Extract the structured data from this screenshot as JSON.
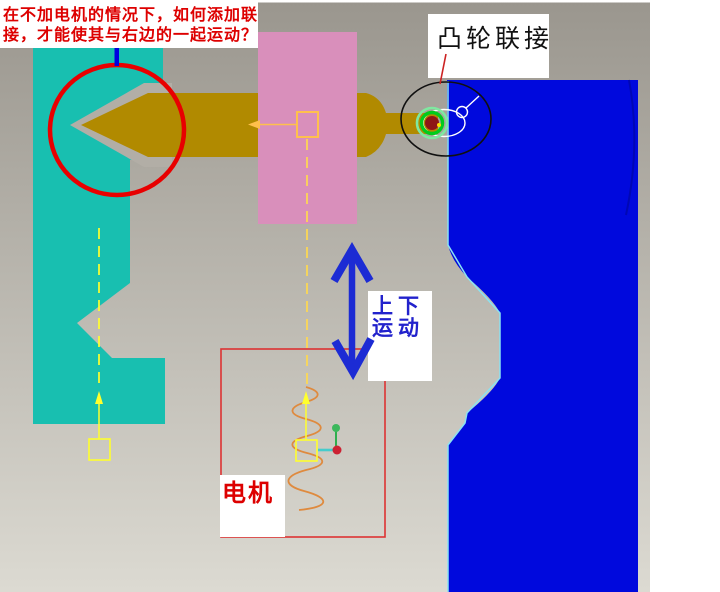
{
  "annotations": {
    "question": {
      "line1": "在不加电机的情况下，如何添加联",
      "line2": "接，才能使其与右边的一起运动？"
    },
    "cam_joint_label": "凸轮联接",
    "motion_label": {
      "line1": "上下",
      "line2": "运动"
    },
    "motor_label": "电机"
  },
  "parts": [
    {
      "name": "follower-slide",
      "color_key": "follower_teal"
    },
    {
      "name": "arrow-shaft",
      "color_key": "shaft_olive"
    },
    {
      "name": "slider-block",
      "color_key": "slider_pink"
    },
    {
      "name": "cam-body",
      "color_key": "cam_blue"
    }
  ],
  "symbols": [
    "cam-joint-rings",
    "slider-joint-square",
    "axis-centerline-dashed",
    "servo-motor-spring",
    "coordinate-triad",
    "up-down-motion-arrow"
  ],
  "colors": {
    "background_top": "#9a968e",
    "background_bottom": "#dcdad2",
    "side_strip_white": "#ffffff",
    "follower_teal": "#18bfb0",
    "shaft_olive": "#b18a00",
    "slider_pink": "#d98fbb",
    "cam_blue": "#0009dd",
    "cam_edge_highlight": "#8ae2f2",
    "cam_inner_edge": "#0007b4",
    "annotation_red": "#e80000",
    "leader_red": "#cc2222",
    "question_text_red": "#dd0000",
    "cam_label_text": "#111111",
    "motion_text_blue": "#2222cc",
    "motor_text_red": "#dd0000",
    "motion_arrow_blue": "#1c2bd4",
    "axis_tick_blue": "#0000e0",
    "symbol_yellow": "#ffff2e",
    "symbol_orange": "#ffc04c",
    "dash_yellow": "#ffd94f",
    "spring_orange": "#df8a3e",
    "joint_green": "#00cc1c",
    "joint_green_light": "#7fe8a0",
    "joint_dark_red": "#8e1616",
    "joint_dot_yellow": "#ffe000",
    "annotation_black": "#101010",
    "annotation_white": "#ffffff",
    "motor_box_red": "#dd3333",
    "notch_gap_gray": "#b2aea6",
    "triad_green": "#2fae4e",
    "triad_green_dot": "#3cb85c",
    "triad_cyan": "#45cccc",
    "triad_red": "#cc2233",
    "label_box_white": "#ffffff"
  }
}
